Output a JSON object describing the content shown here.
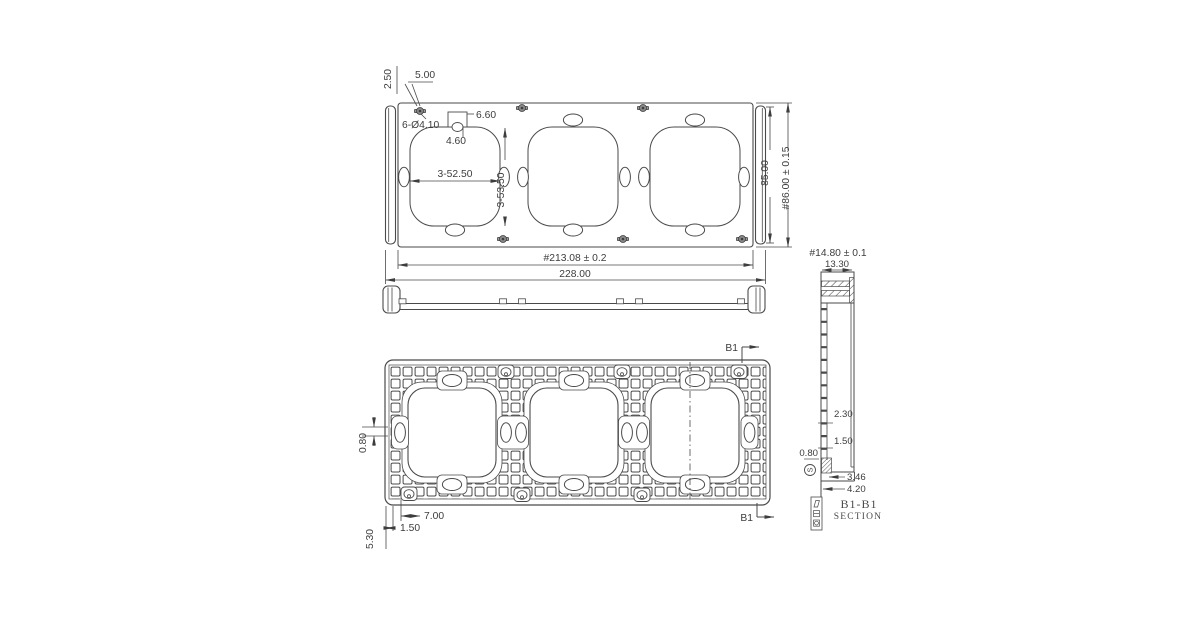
{
  "colors": {
    "line": "#4a4a4a",
    "text": "#3d3d3d",
    "background": "#ffffff"
  },
  "views": {
    "top": {
      "dims": {
        "corner_offset_v": "2.50",
        "corner_offset_h": "5.00",
        "mount_holes": "6-Ø4.10",
        "tab_width": "6.60",
        "tab_depth": "4.60",
        "opening_width": "3-52.50",
        "opening_height": "3-53.50",
        "end_cap_height": "85.00",
        "overall_height": "#86.00 ± 0.15",
        "hole_span": "#213.08 ± 0.2",
        "overall_width": "228.00"
      }
    },
    "back": {
      "dims": {
        "rib_width": "0.80",
        "boss_offset": "7.00",
        "edge_offset": "1.50",
        "corner_offset": "5.30"
      },
      "section_marker": "B1"
    },
    "section": {
      "dims": {
        "overall_depth": "#14.80 ± 0.1",
        "cap_width": "13.30",
        "wall_a": "2.30",
        "wall_b": "1.50",
        "rib": "0.80",
        "base_a": "3.46",
        "base_b": "4.20"
      },
      "datum": "S",
      "title": "B1-B1",
      "subtitle": "SECTION"
    }
  }
}
